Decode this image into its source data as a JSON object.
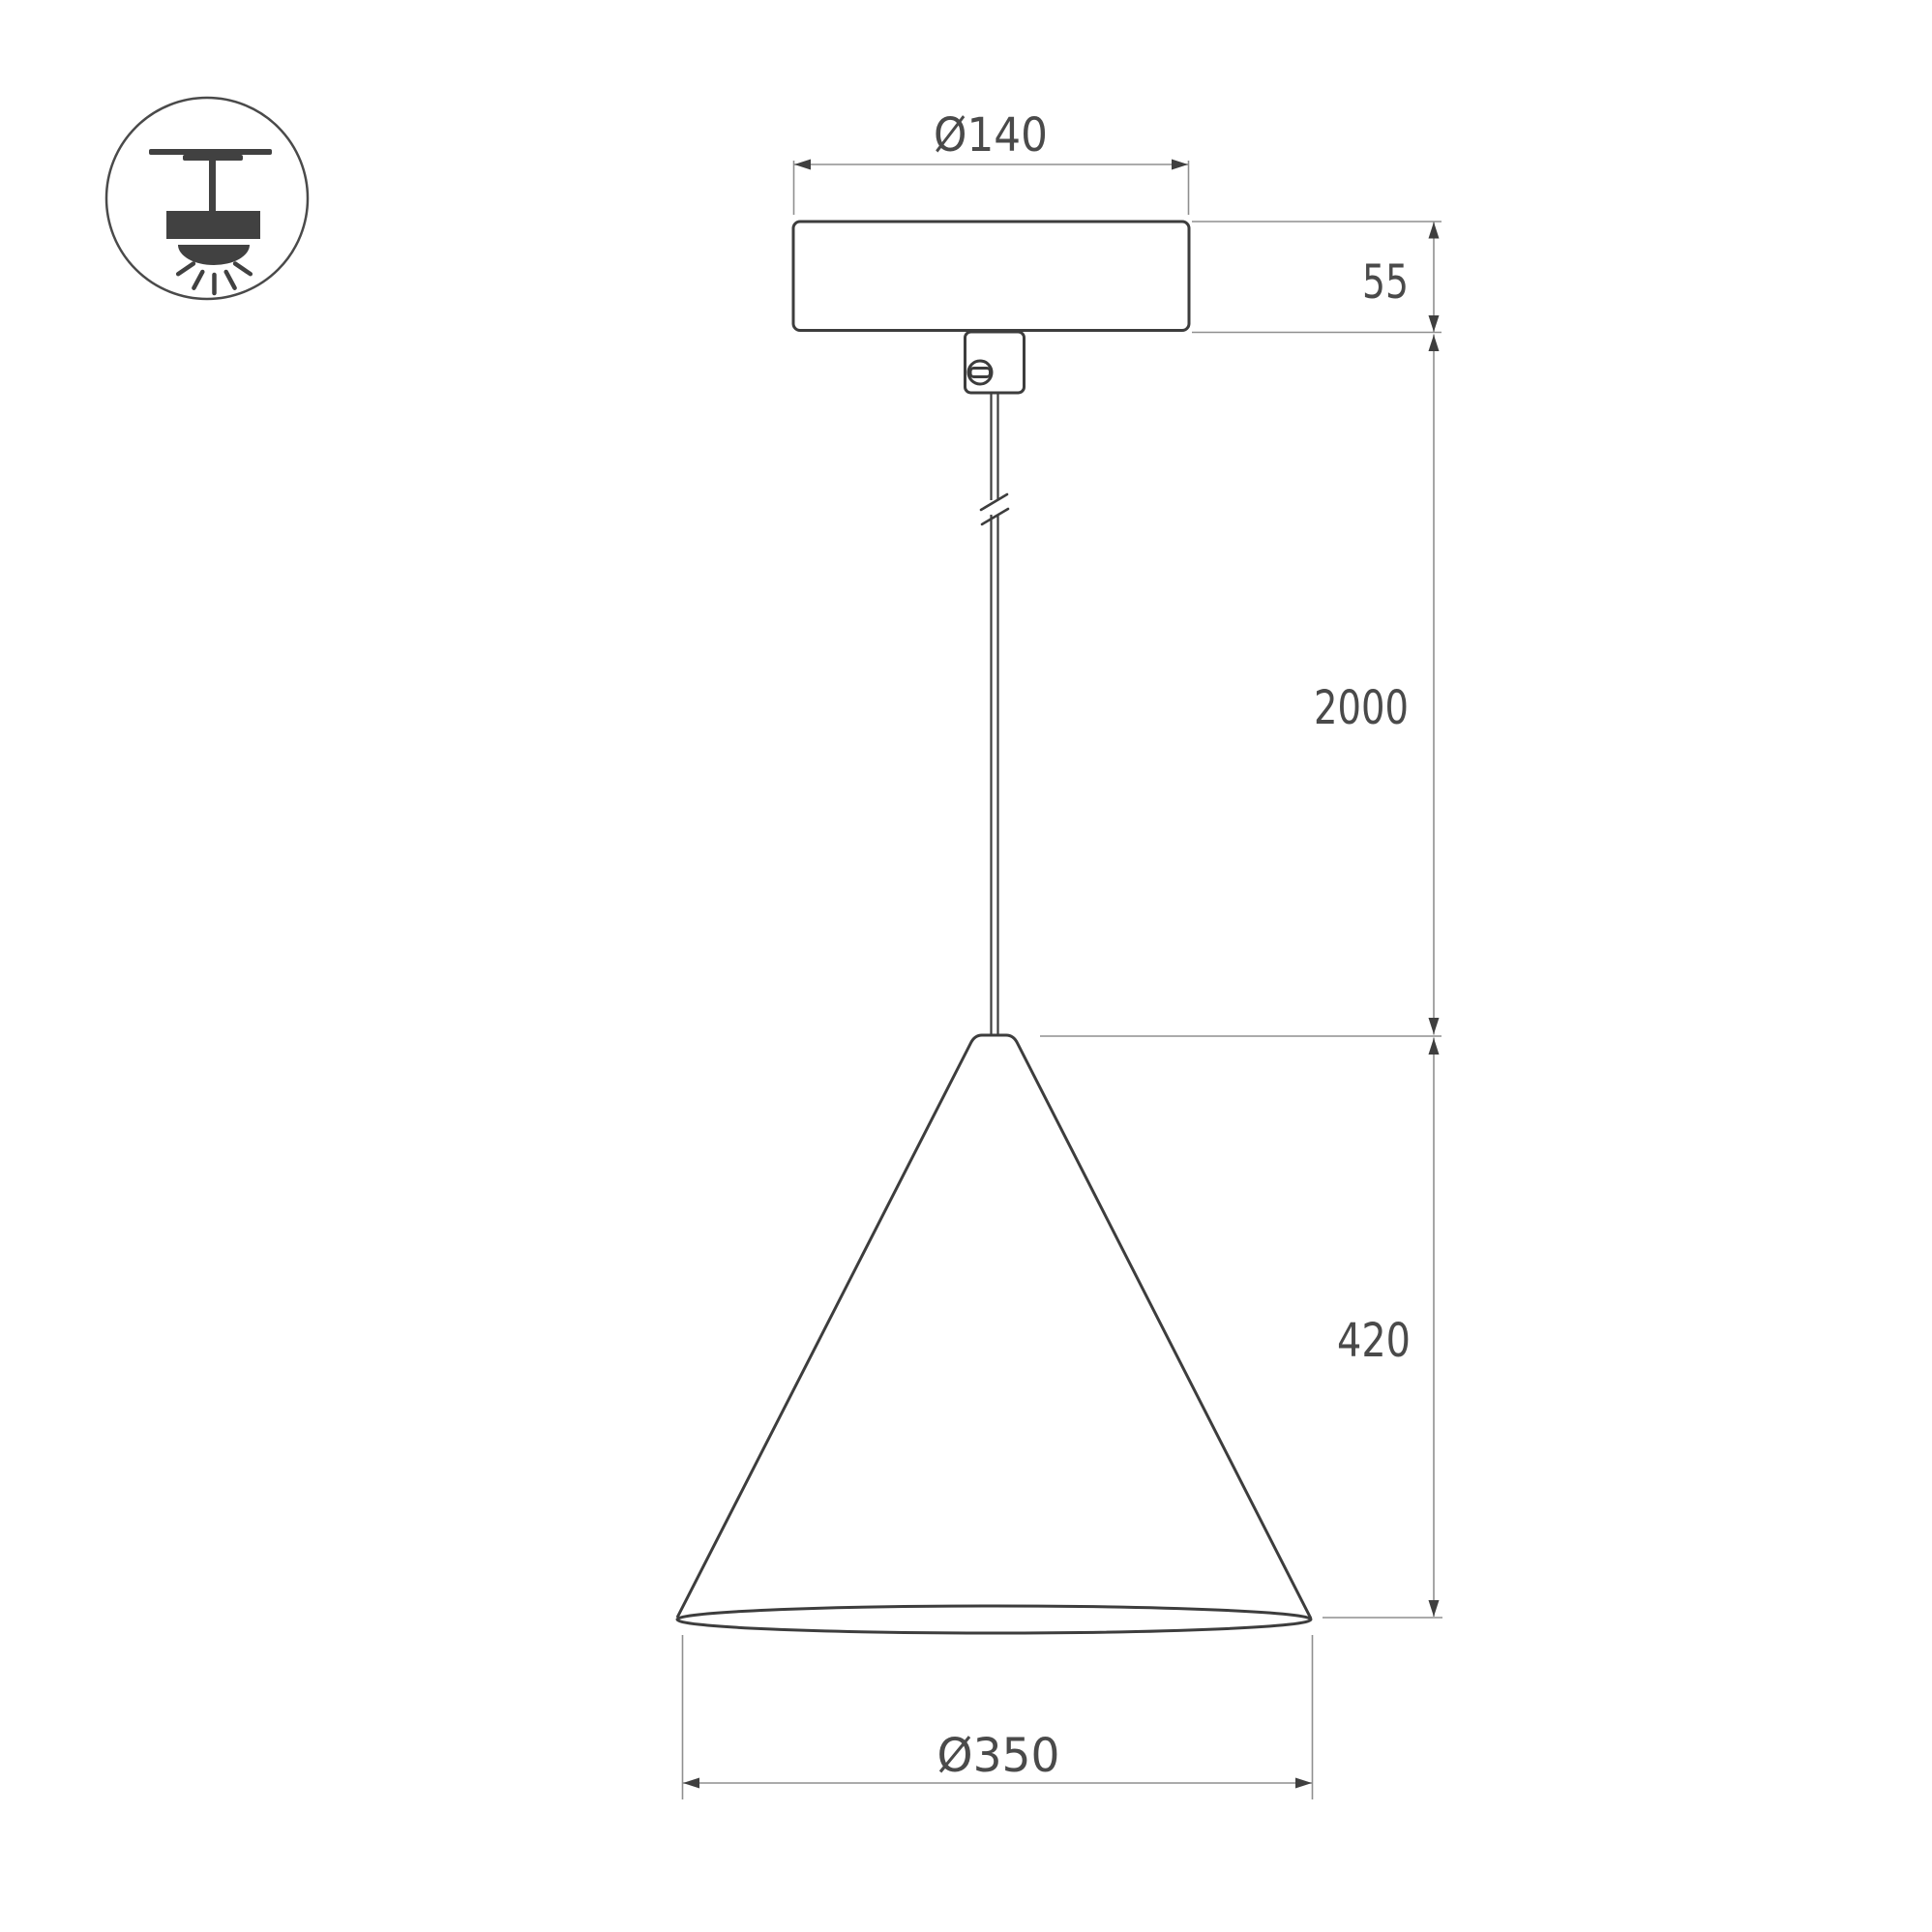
{
  "drawing": {
    "kind": "pendant-luminaire-dimension-drawing"
  },
  "icon": {
    "name": "pendant-ceiling-mount-symbol"
  },
  "dimensions": {
    "canopy_diameter": {
      "label": "Ø140"
    },
    "canopy_height": {
      "label": "55"
    },
    "cable_length": {
      "label": "2000"
    },
    "shade_height": {
      "label": "420"
    },
    "shade_diameter": {
      "label": "Ø350"
    }
  },
  "colors": {
    "background": "#ffffff",
    "object_line": "#3d3d3d",
    "dimension_line": "#8f8f8f",
    "dimension_text": "#4a4a4a",
    "arrowhead": "#3f3f3f",
    "icon_fill": "#414141"
  }
}
